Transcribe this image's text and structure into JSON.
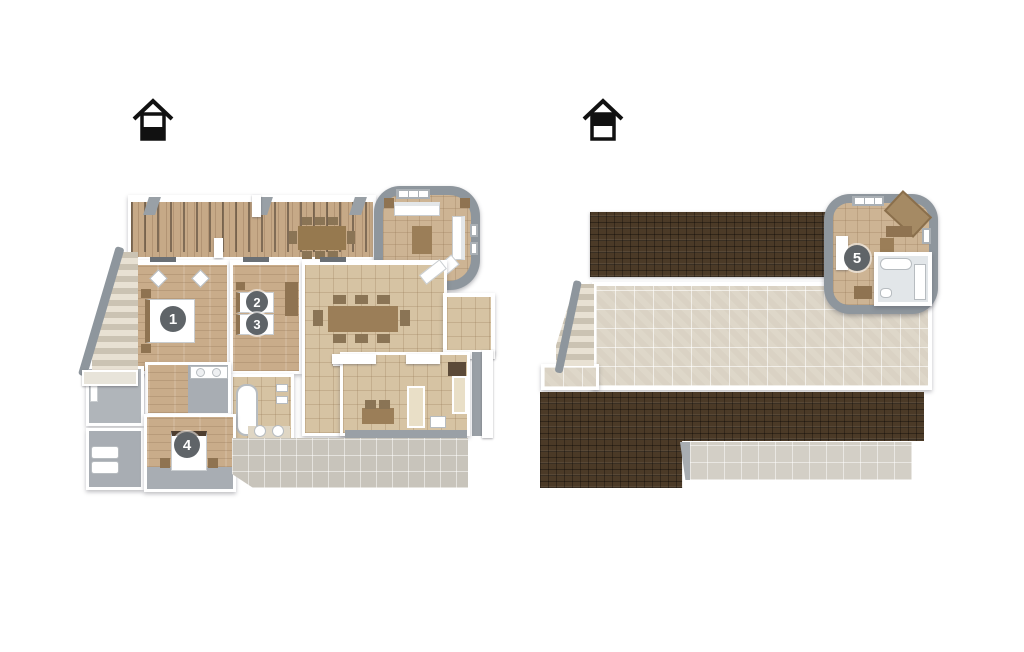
{
  "canvas": {
    "width": 1024,
    "height": 652,
    "background": "#ffffff"
  },
  "floor_selector": {
    "ground": {
      "icon": "house-icon-lower-half-filled"
    },
    "upper": {
      "icon": "house-icon-upper-half-filled"
    }
  },
  "markers": {
    "ground": [
      {
        "number": "1"
      },
      {
        "number": "2"
      },
      {
        "number": "3"
      },
      {
        "number": "4"
      }
    ],
    "upper": [
      {
        "number": "5"
      }
    ]
  },
  "colors": {
    "badge": "#5f6468",
    "wall_white": "#ffffff",
    "wall_gray": "#8e969d",
    "wood_floor": "#c9ac8a",
    "living_tile": "#d6c3a3",
    "terrace_tile": "#ded7c9",
    "roof_tile": "#4b3a27",
    "patio_tile": "#c8c4bb"
  }
}
